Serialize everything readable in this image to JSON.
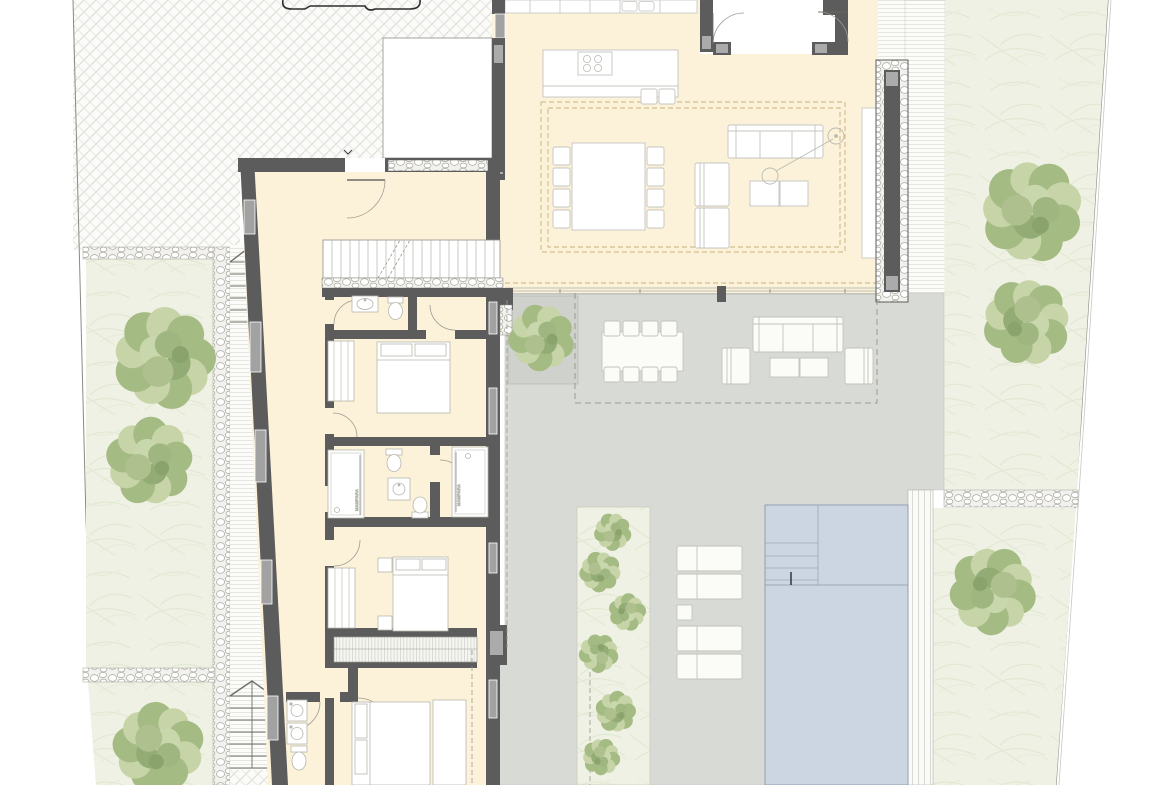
{
  "plan": {
    "labels": {
      "shower_screen_left": "MAMPARA",
      "shower_screen_right": "MAMPARA"
    },
    "palette": {
      "floor_cream": "#fbf2d9",
      "wall_dark": "#5c5c5c",
      "wall_cap_gray": "#ababab",
      "terrace_gray": "#d8dad6",
      "pool_blue": "#ccd6e3",
      "garden_green": "#eef1e3",
      "tree_green": "#a9bd88",
      "paving_line": "#dddcd6",
      "dashed_tan": "#c9b27e",
      "furniture_line": "#bcbcb4"
    }
  }
}
